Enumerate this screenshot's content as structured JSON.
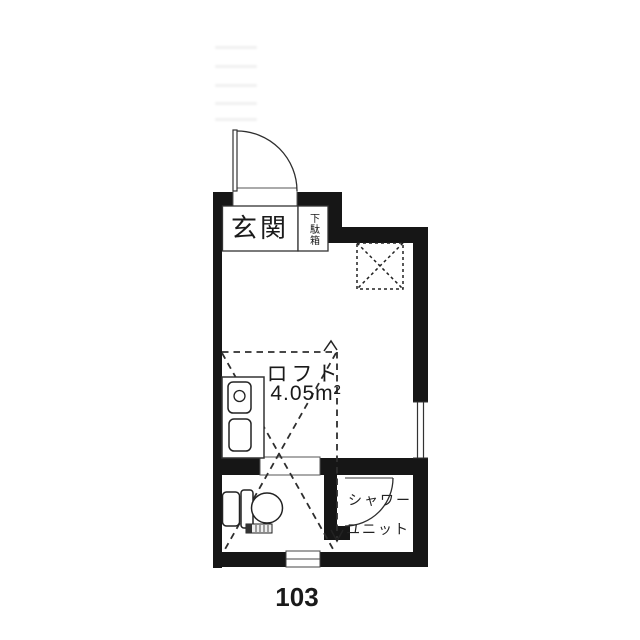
{
  "floor_plan": {
    "unit_number": "103",
    "labels": {
      "entrance": "玄関",
      "shoe_cabinet": "下駄箱",
      "loft_name": "ロフト",
      "loft_area": "4.05m²",
      "shower_line1": "シャワー",
      "shower_line2": "ユニット"
    },
    "features": [
      "entry-door-swing",
      "entry-threshold",
      "shoe-cabinet-box",
      "void-x-mark",
      "loft-dashed-outline",
      "kitchen-counter",
      "sink",
      "toilet",
      "doorway-threshold",
      "shower-door-swing",
      "window-right",
      "window-bottom"
    ],
    "colors": {
      "wall": "#161616",
      "line": "#2e2e2e",
      "text": "#1a1a1a"
    }
  }
}
